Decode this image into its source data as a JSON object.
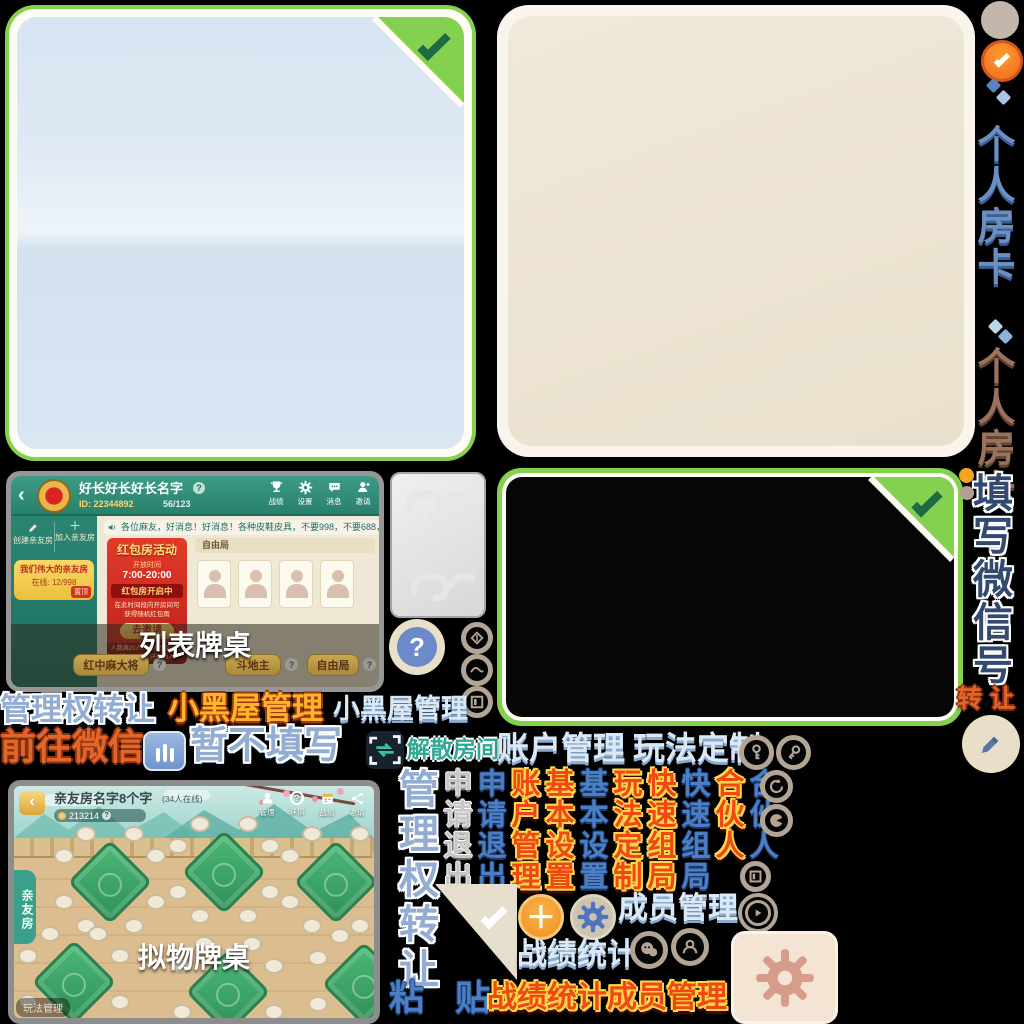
{
  "rail": {
    "room_card_blue": "个人房卡",
    "room_card_brown": "个人房卡",
    "fill_wechat": "填写微信号",
    "transfer": "转让"
  },
  "word_art": {
    "manage_transfer": "管理权转让",
    "black_room_gold": "小黑屋管理",
    "black_room_pale": "小黑屋管理",
    "goto_wechat": "前往微信",
    "skip_fill": "暂不填写",
    "dissolve_room": "解散房间",
    "account_manage": "账户管理",
    "gameplay_custom": "玩法定制",
    "paste_char1": "粘",
    "paste_char2": "贴",
    "stats": "战绩统计",
    "members": "成员管理",
    "stats_members": "战绩统计成员管理"
  },
  "columns": [
    {
      "text": "管理权转让",
      "style": "outblue",
      "tall": true
    },
    {
      "text": "申请退出",
      "style": "grey"
    },
    {
      "text": "申请退出",
      "style": "blue"
    },
    {
      "text": "账户管理",
      "style": "red"
    },
    {
      "text": "基本设置",
      "style": "red"
    },
    {
      "text": "基本设置",
      "style": "blue"
    },
    {
      "text": "玩法定制",
      "style": "red"
    },
    {
      "text": "快速组局",
      "style": "red"
    },
    {
      "text": "快速组局",
      "style": "blue"
    },
    {
      "text": "合伙人",
      "style": "red"
    },
    {
      "text": "合伙人",
      "style": "blue"
    }
  ],
  "glyphs": {
    "question": "?",
    "back": "‹",
    "plus": "＋"
  },
  "lobby_list": {
    "title": "好长好长好长名字",
    "room_id": "ID: 22344892",
    "member_count": "56/123",
    "nav_labels": [
      "战绩",
      "设置",
      "消息",
      "邀请"
    ],
    "create_room": "创建亲友房",
    "join_room": "加入亲友房",
    "room_card_name": "我们伟大的亲友房",
    "room_card_online": "在线: 12/998",
    "room_card_tag": "置顶",
    "marquee": "各位麻友，好消息！好消息！各种皮鞋皮具，不要998，不要688，只要98元，只要9",
    "banner_title": "红包房活动",
    "banner_open_label": "开放时间",
    "banner_time": "7:00-20:00",
    "banner_status": "红包房开启中",
    "banner_desc": "在此时间段内开房间可获得随机红包雨",
    "banner_button": "去邀请",
    "banner_note": "人数满20人的亲友房可参加活动，当前只有13人",
    "lobby_tab": "自由局",
    "caption": "列表牌桌",
    "table_buttons": [
      "红中麻大将",
      "斗地主",
      "自由局"
    ]
  },
  "lobby_real": {
    "title": "亲友房名字8个字",
    "subtitle": "(34人在线)",
    "room_id": "213214",
    "nav_labels": [
      "管理",
      "详情",
      "战绩",
      "邀请"
    ],
    "side_tab": "亲友房",
    "caption": "拟物牌桌",
    "corner_pill": "玩法管理"
  }
}
